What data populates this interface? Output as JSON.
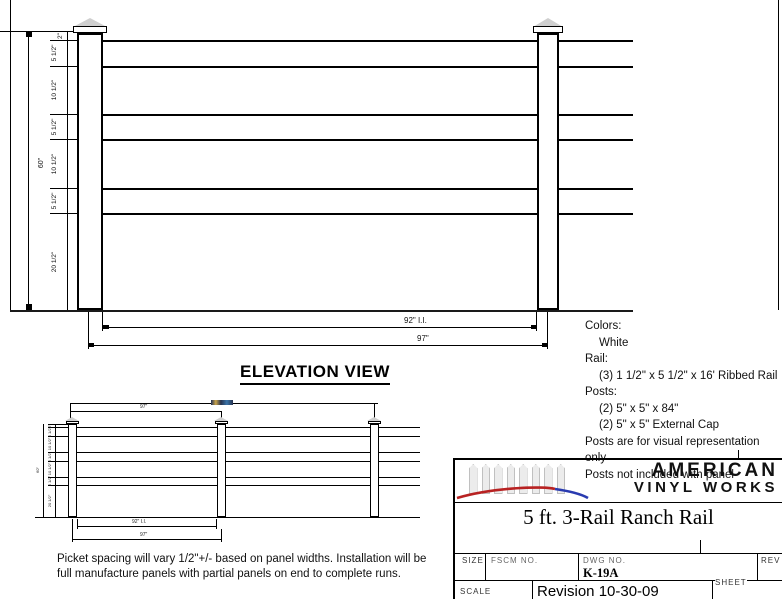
{
  "main_view": {
    "heading": "ELEVATION VIEW",
    "height_label": "60\"",
    "segments": [
      "2\"",
      "5 1/2\"",
      "10 1/2\"",
      "5 1/2\"",
      "10 1/2\"",
      "5 1/2\"",
      "20 1/2\""
    ],
    "inner_width_label": "92\" I.I.",
    "outer_width_label": "97\""
  },
  "small_view": {
    "height_label": "60\"",
    "segments": [
      "2\"",
      "5 1/2\"",
      "10 1/2\"",
      "5 1/2\"",
      "10 1/2\"",
      "5 1/2\"",
      "20 1/2\""
    ],
    "top_panel_width_label": "97\"",
    "bottom_inner_width_label": "92\" I.I.",
    "bottom_outer_width_label": "97\"",
    "overall_width_label": ""
  },
  "notes": {
    "lines": [
      {
        "text": "Colors:",
        "indent": 0
      },
      {
        "text": "White",
        "indent": 1
      },
      {
        "text": "Rail:",
        "indent": 0
      },
      {
        "text": "(3) 1 1/2\" x 5 1/2\" x 16' Ribbed Rail",
        "indent": 1
      },
      {
        "text": "Posts:",
        "indent": 0
      },
      {
        "text": "(2) 5\" x 5\" x 84\"",
        "indent": 1
      },
      {
        "text": "(2) 5\" x 5\" External Cap",
        "indent": 1
      },
      {
        "text": "Posts are for visual representation only",
        "indent": 0
      },
      {
        "text": "Posts not included with panel",
        "indent": 0
      }
    ]
  },
  "footnote": {
    "lines": [
      "Picket spacing will vary 1/2\"+/- based on panel widths.  Installation will be",
      "full manufacture panels with partial panels on end to complete runs."
    ]
  },
  "title_block": {
    "brand_line1": "AMERICAN",
    "brand_line2": "VINYL WORKS",
    "product_title": "5 ft. 3-Rail Ranch Rail",
    "size_label": "SIZE",
    "fscm_label": "FSCM NO.",
    "dwg_label": "DWG NO.",
    "dwg_no": "K-19A",
    "rev_label": "REV",
    "scale_label": "SCALE",
    "revision": "Revision 10-30-09",
    "sheet_label": "SHEET"
  },
  "colors": {
    "line": "#000000",
    "swoosh_red": "#b82222",
    "swoosh_blue": "#2a3bb0",
    "logo_gray": "#c8c8c8"
  }
}
